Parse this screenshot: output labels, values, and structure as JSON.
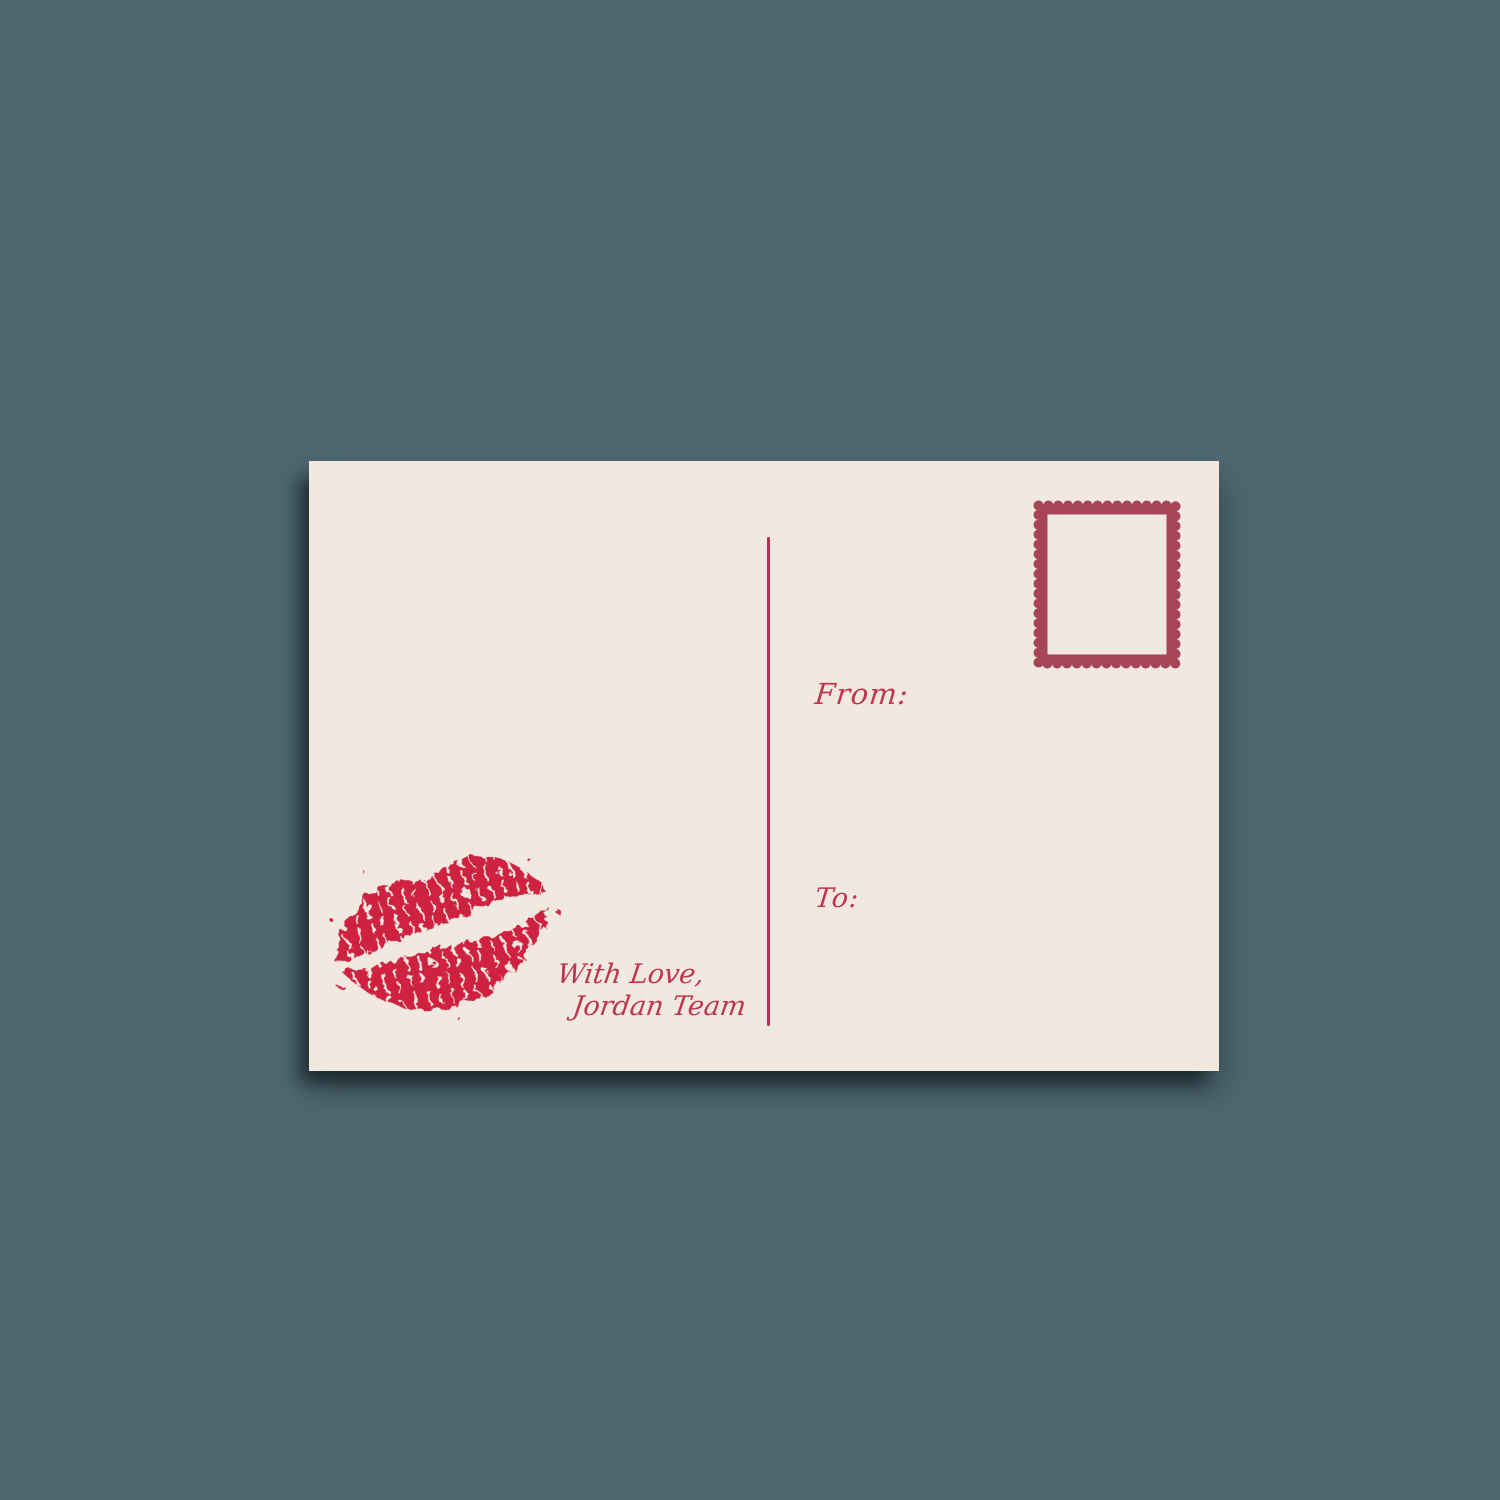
{
  "scene": {
    "background_color": "#4d6771",
    "description": "postcard back mockup on plain slate background"
  },
  "postcard": {
    "card_color": "#f1e8e0",
    "labels": {
      "from": "From:",
      "to": "To:"
    },
    "signature": {
      "line1": "With Love,",
      "line2": "Jordan Team"
    },
    "colors": {
      "kiss_red": "#ce2040",
      "script_red": "#bf3551",
      "divider_red": "#b53251",
      "stamp_border_red": "#a84458"
    },
    "icons": {
      "kiss": "lipstick-kiss-icon",
      "stamp": "postage-stamp-placeholder-icon"
    }
  }
}
